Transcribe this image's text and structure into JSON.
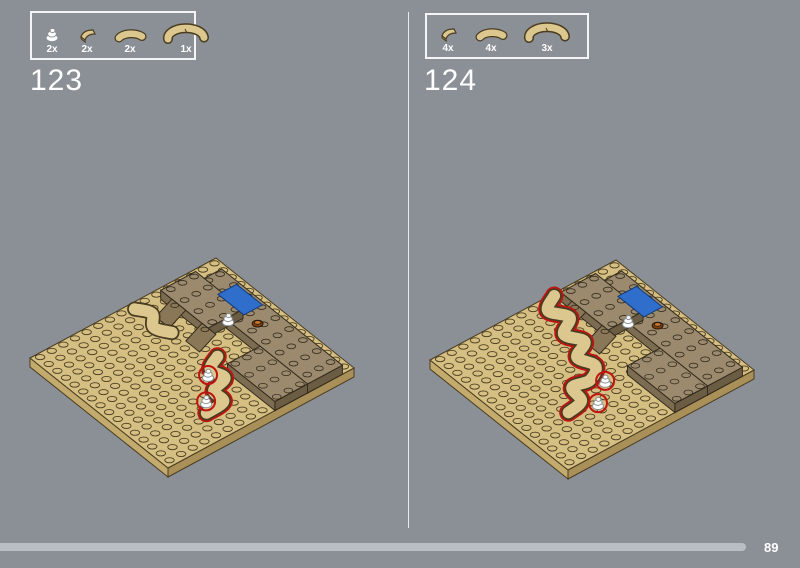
{
  "page": {
    "number": "89"
  },
  "steps": [
    {
      "number": "123",
      "parts": [
        {
          "name": "white-spiral-shell",
          "count": "2x"
        },
        {
          "name": "tan-quarter-round-tile",
          "count": "2x"
        },
        {
          "name": "tan-curved-macaroni-tile",
          "count": "2x"
        },
        {
          "name": "tan-large-curved-tile",
          "count": "1x"
        }
      ]
    },
    {
      "number": "124",
      "parts": [
        {
          "name": "tan-quarter-round-tile",
          "count": "4x"
        },
        {
          "name": "tan-curved-macaroni-tile",
          "count": "4x"
        },
        {
          "name": "tan-large-curved-tile",
          "count": "3x"
        }
      ]
    }
  ],
  "colors": {
    "background": "#8a9096",
    "panel_divider": "#e8eaec",
    "box_border": "#f2f4f6",
    "text": "#ffffff",
    "progress_bar": "#b8bec3",
    "plate_tan": "#d5bf82",
    "plate_tan_light": "#dcc88f",
    "plate_side_left": "#c3aa6d",
    "plate_side_right": "#a98f58",
    "tan_outline": "#4a3c20",
    "slab_top": "#9b8a6e",
    "slab_front": "#7c6c52",
    "slab_side": "#6b5c44",
    "slab_outline": "#332b1c",
    "wedge": "#8a7757",
    "blue_tile": "#2f6fcb",
    "blue_outline": "#143a75",
    "red_outline": "#bf1512",
    "shell_white": "#ffffff",
    "shell_line": "#8a9094",
    "brown_piece": "#7b3f12",
    "brown_highlight": "#c57a2e"
  }
}
